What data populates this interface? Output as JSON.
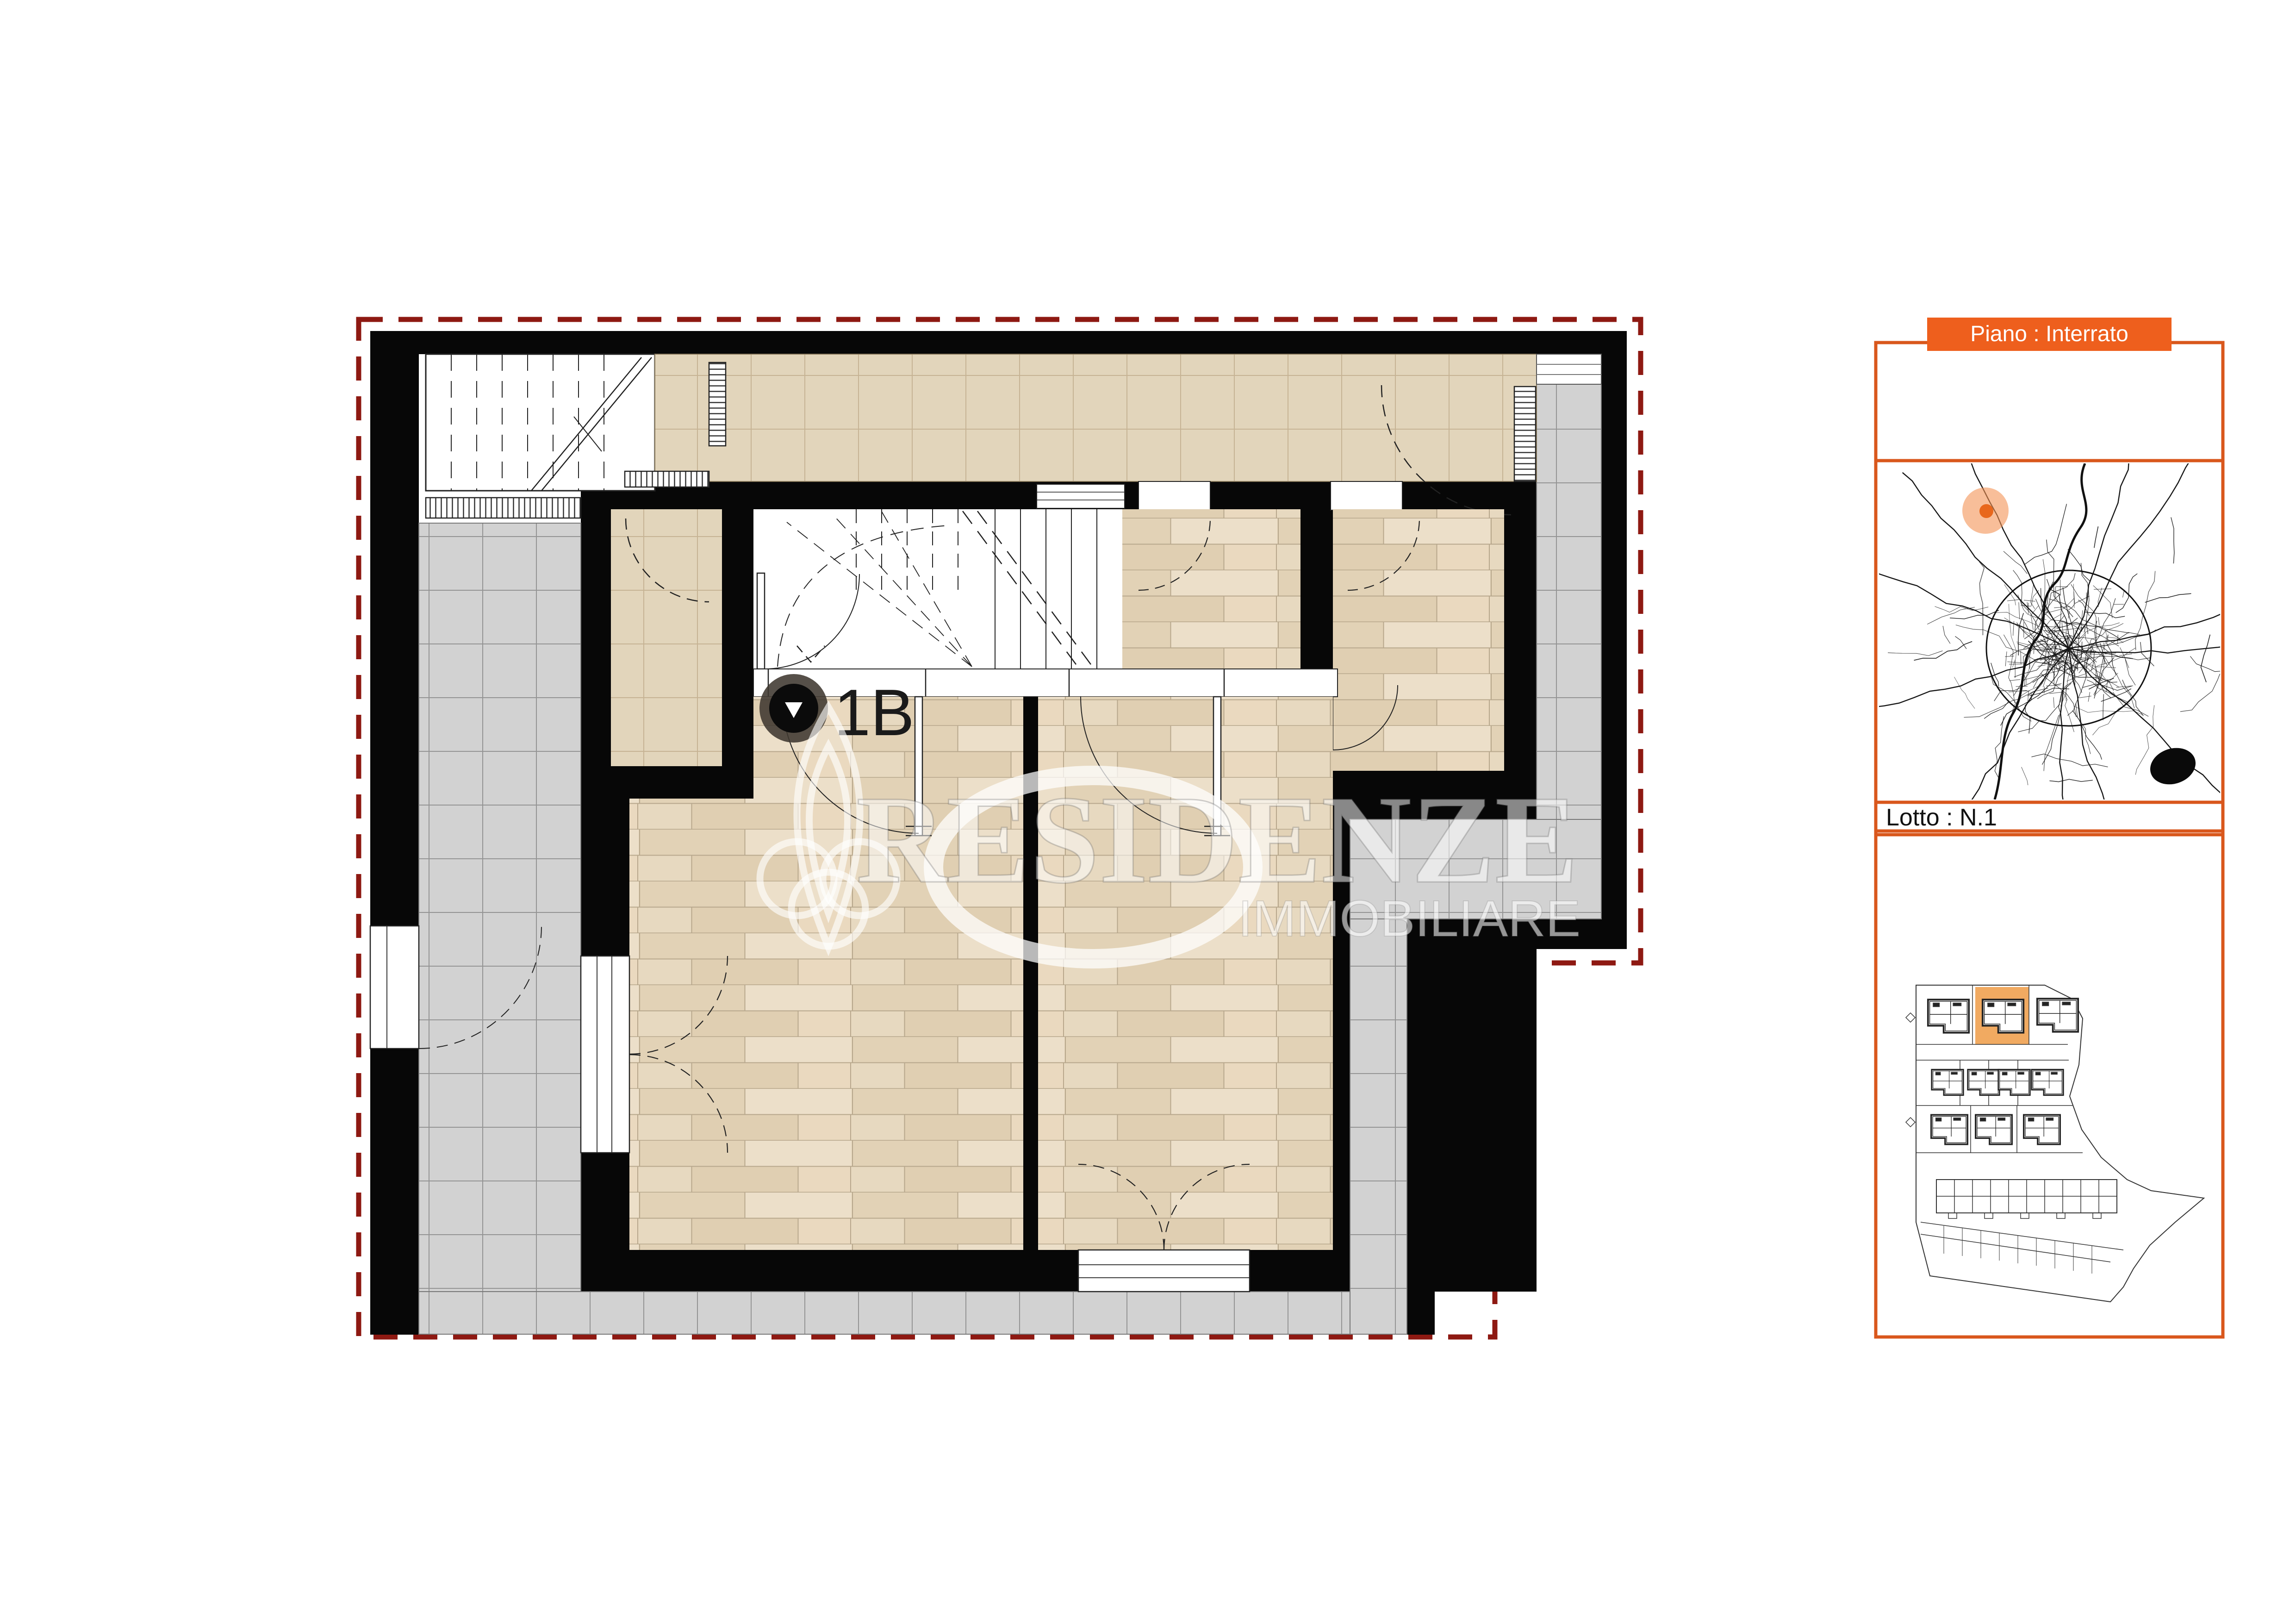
{
  "plan": {
    "unit_label": "1B",
    "floor_type": "basement-floor-plan"
  },
  "watermark": {
    "title": "RESIDENZE",
    "subtitle": "IMMOBILIARE"
  },
  "panel": {
    "floor_label": "Piano : Interrato",
    "lot_label": "Lotto : N.1"
  },
  "colors": {
    "accent_border": "#d9571c",
    "accent_fill": "#ee5f1d",
    "boundary": "#8e1912",
    "marker_dot": "#e8671c",
    "marker_halo": "#f39255",
    "lot_highlight": "#f0a150",
    "wall": "#070707",
    "walkway_tile": "#d2d2d2",
    "terrace_tile": "#e2d5bb",
    "wood": "#e7d9c0"
  }
}
